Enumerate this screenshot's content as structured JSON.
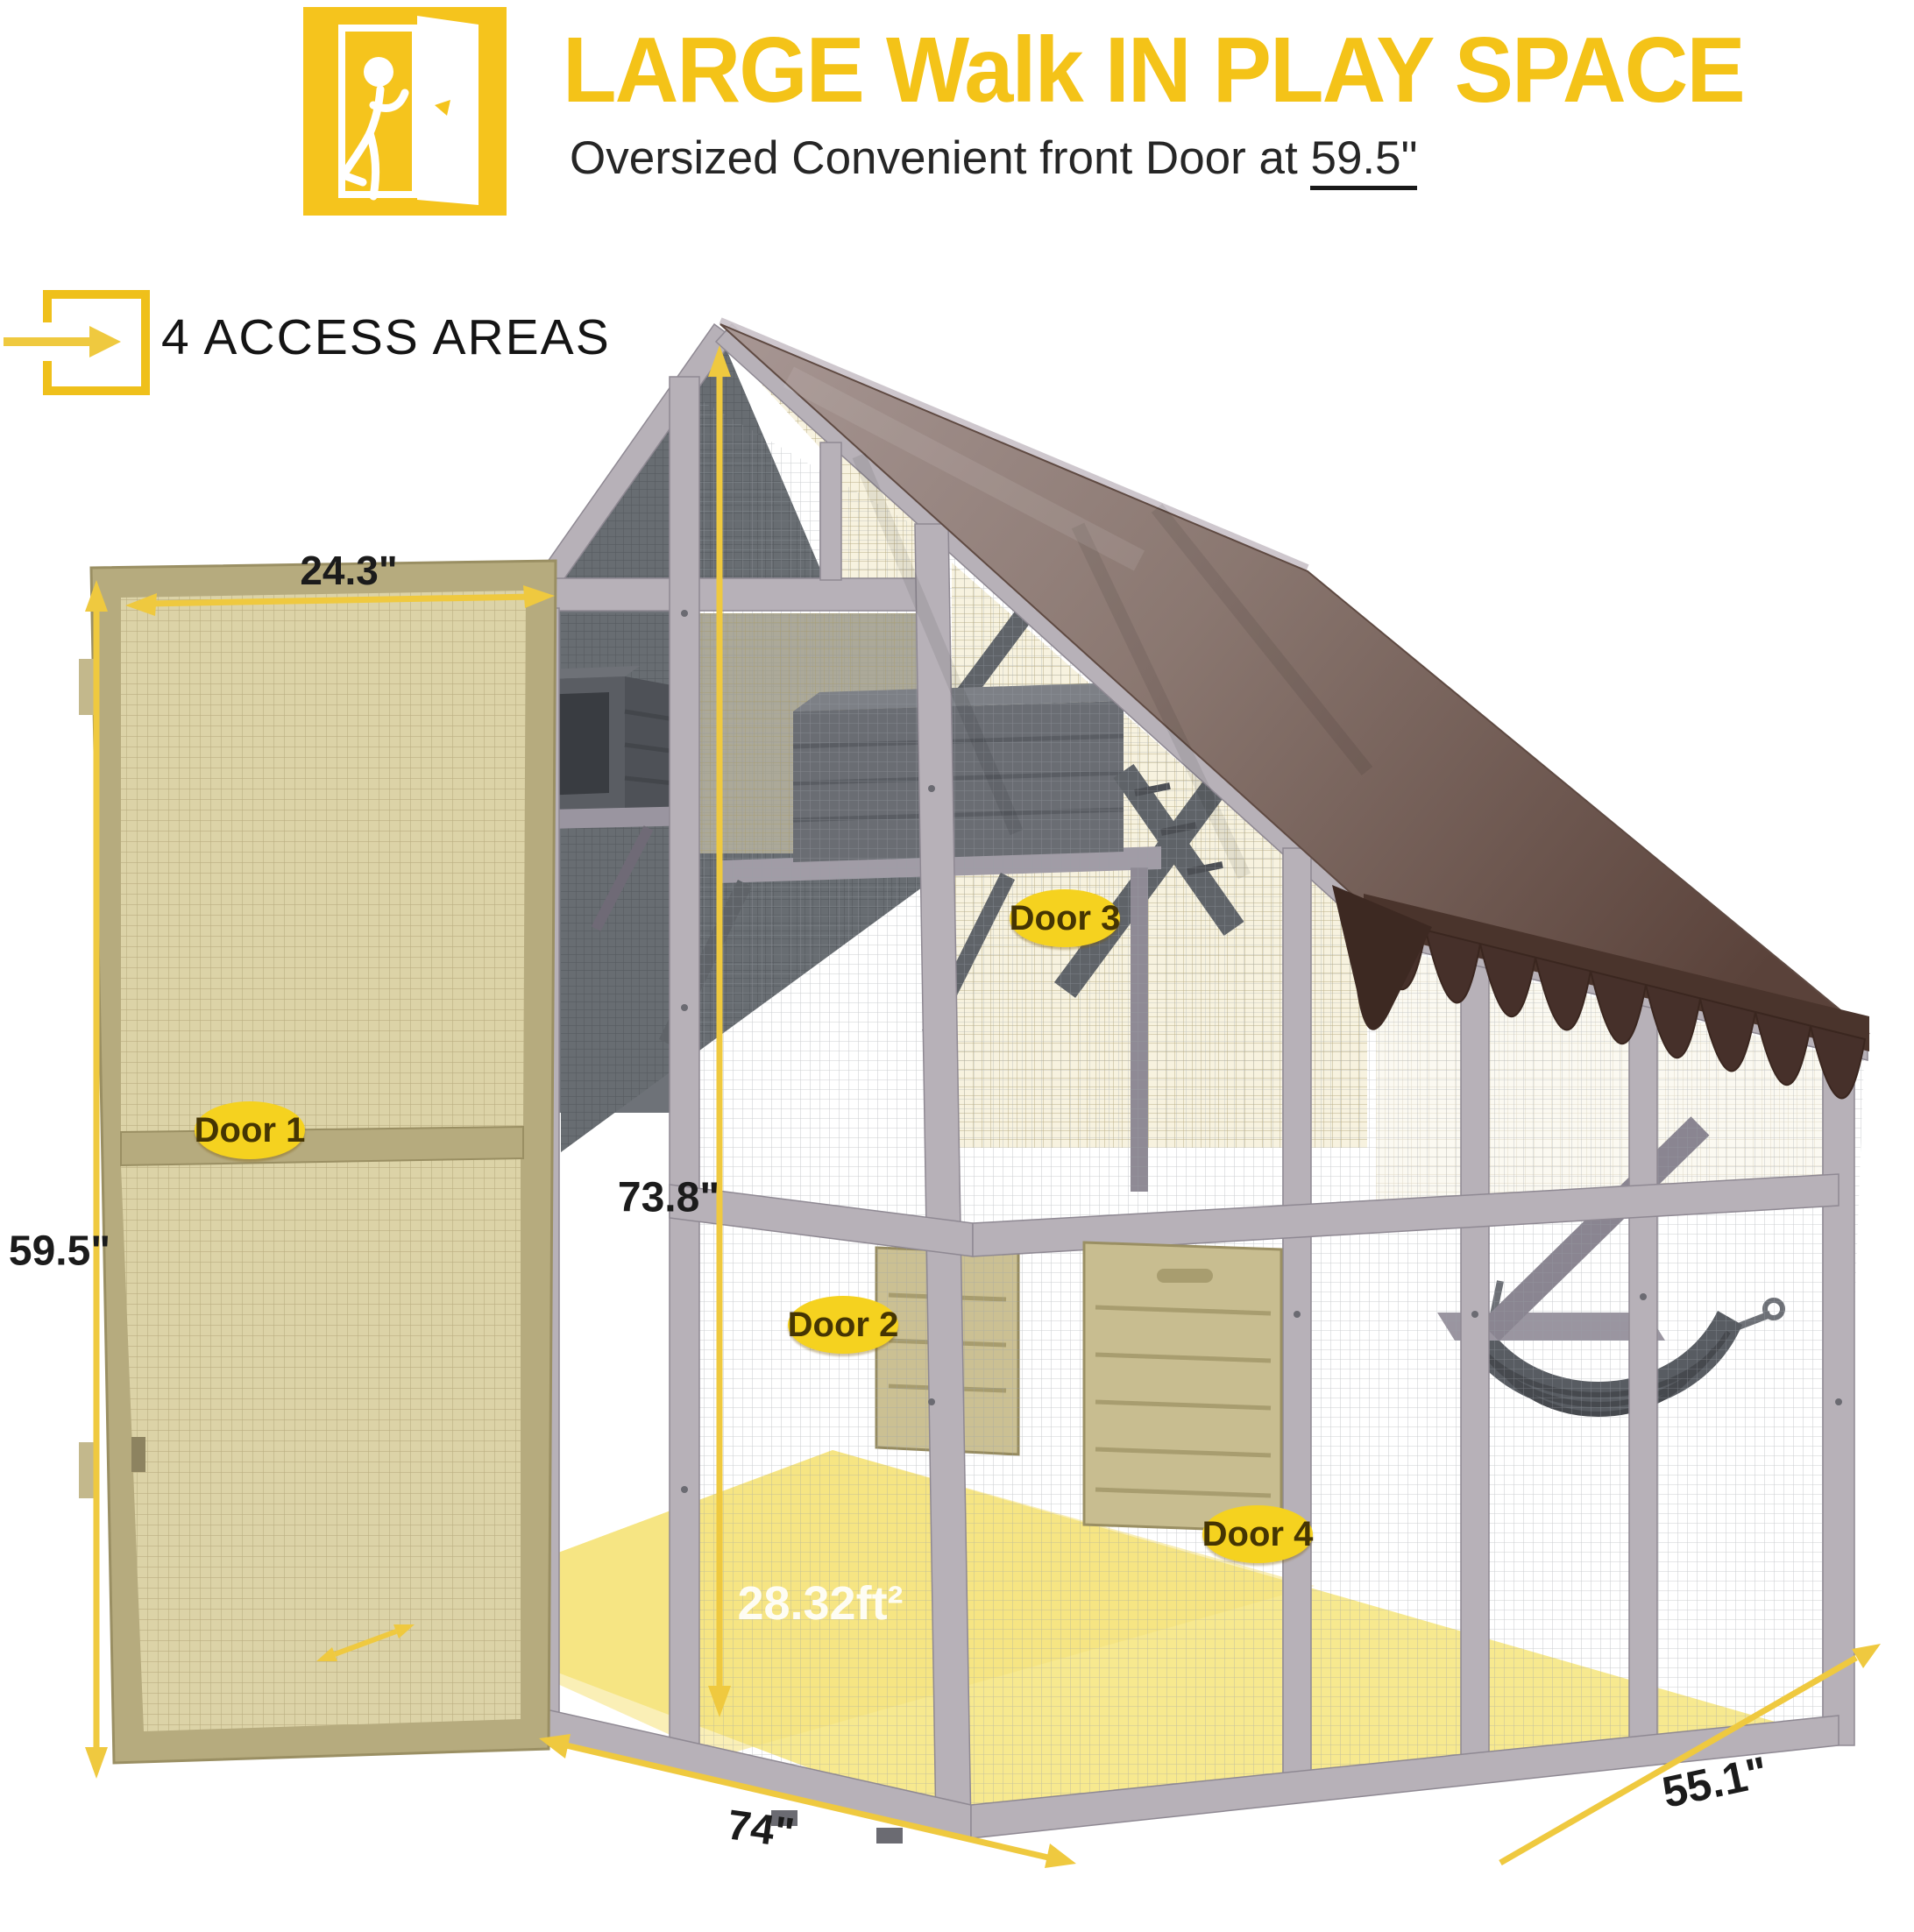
{
  "header": {
    "title": "LARGE Walk IN PLAY SPACE",
    "subtitle_prefix": "Oversized Convenient front Door at ",
    "subtitle_value": "59.5\"",
    "access_areas_label": "4 ACCESS AREAS"
  },
  "dimensions": {
    "door_width": "24.3\"",
    "door_height": "59.5\"",
    "inner_height": "73.8\"",
    "front_width": "74\"",
    "side_depth": "55.1\"",
    "floor_area": "28.32ft²"
  },
  "doors": [
    {
      "label": "Door 1"
    },
    {
      "label": "Door 2"
    },
    {
      "label": "Door 3"
    },
    {
      "label": "Door 4"
    }
  ],
  "icons": {
    "walk_in_door_icon": "person walking through open door",
    "access_arrow_icon": "arrow entering square"
  },
  "colors": {
    "accent_yellow": "#F5C41D",
    "badge_yellow": "#F5D21F",
    "arrow_yellow": "#EFC93F",
    "tarp_brown": "#8A7770",
    "valance_brown": "#46302A",
    "frame_gray": "#B7B1B8",
    "tan_wood": "#B5AA7D",
    "floor_yellow": "#F7E98F"
  }
}
